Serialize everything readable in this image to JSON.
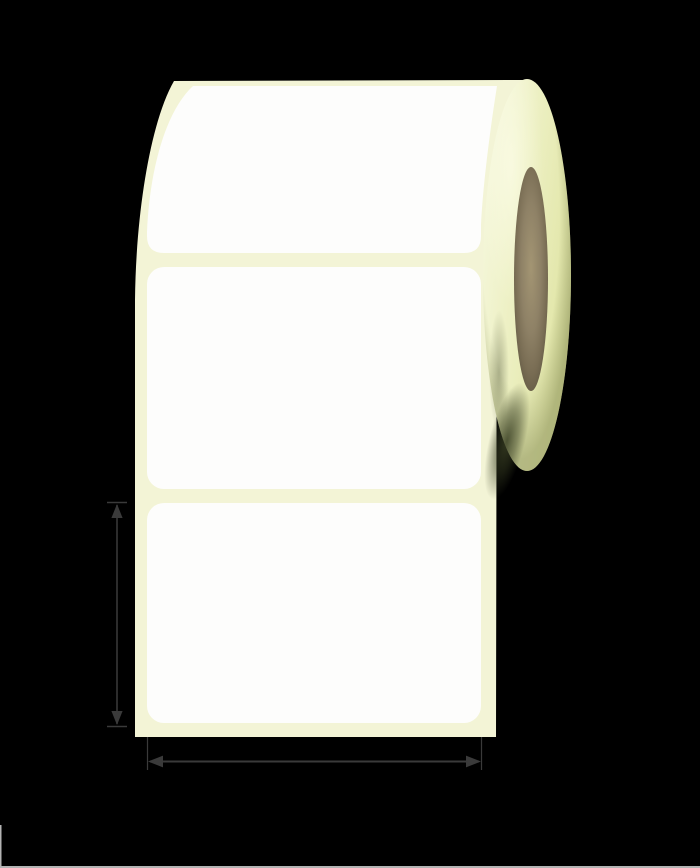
{
  "scene": {
    "subject": "blank-label-roll-product-render",
    "visible_labels_on_strip": 3
  },
  "icons": {
    "vertical_dimension_glyph": "double-headed-arrow-vertical",
    "horizontal_dimension_glyph": "double-headed-arrow-horizontal"
  },
  "colors": {
    "background": "#000000",
    "backing_paper": "#f3f4d6",
    "label_face": "#fdfdfc",
    "roll_end_light": "#f6f8df",
    "roll_end_mid": "#eef1c6",
    "roll_end_shaded": "#e4e8ae",
    "roll_end_dark": "#dbe09f",
    "rim_shade": "#828852",
    "highlight": "#ffffee",
    "core_light": "#a39573",
    "core_mid": "#8e8166",
    "core_shaded": "#786c53",
    "core_dark": "#655c46",
    "shadow": "#3a4024",
    "dimension_line": "#3a3a3a",
    "frame_line": "#b3b3b3"
  }
}
